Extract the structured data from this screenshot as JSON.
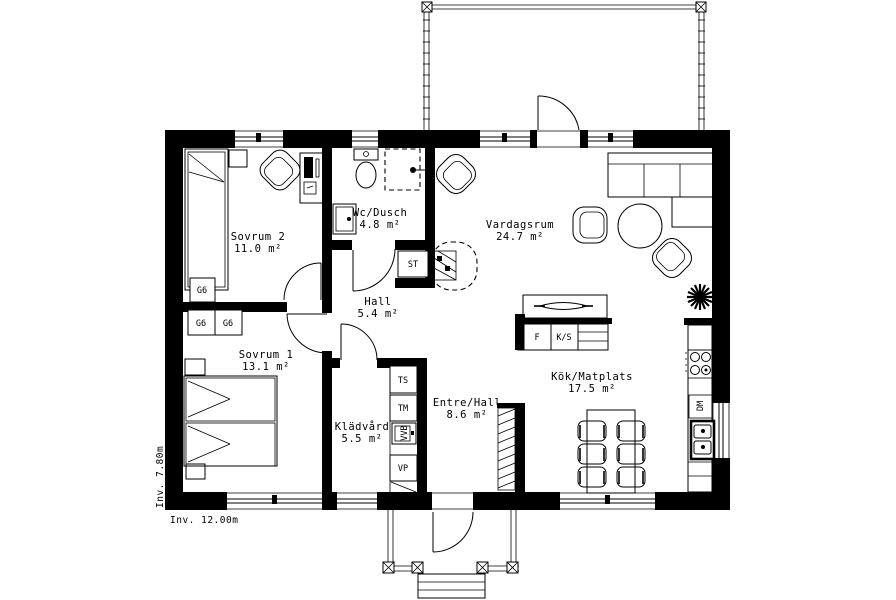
{
  "plan": {
    "rooms": {
      "sovrum2": {
        "name": "Sovrum 2",
        "area": "11.0 m²"
      },
      "wc": {
        "name": "Wc/Dusch",
        "area": "4.8 m²"
      },
      "vardagsrum": {
        "name": "Vardagsrum",
        "area": "24.7 m²"
      },
      "hall": {
        "name": "Hall",
        "area": "5.4 m²"
      },
      "sovrum1": {
        "name": "Sovrum 1",
        "area": "13.1 m²"
      },
      "kladvard": {
        "name": "Klädvård",
        "area": "5.5 m²"
      },
      "entre": {
        "name": "Entre/Hall",
        "area": "8.6 m²"
      },
      "kok": {
        "name": "Kök/Matplats",
        "area": "17.5 m²"
      }
    },
    "fixtures": {
      "g6a": "G6",
      "g6b": "G6",
      "g6c": "G6",
      "st": "ST",
      "ts": "TS",
      "tm": "TM",
      "vvb": "VVB",
      "vp": "VP",
      "f": "F",
      "ks": "K/S",
      "dm": "DM"
    },
    "dimensions": {
      "interior_width": "Inv. 12.00m",
      "interior_height": "Inv. 7.80m"
    },
    "colors": {
      "wall": "#000000",
      "background": "#ffffff"
    }
  }
}
